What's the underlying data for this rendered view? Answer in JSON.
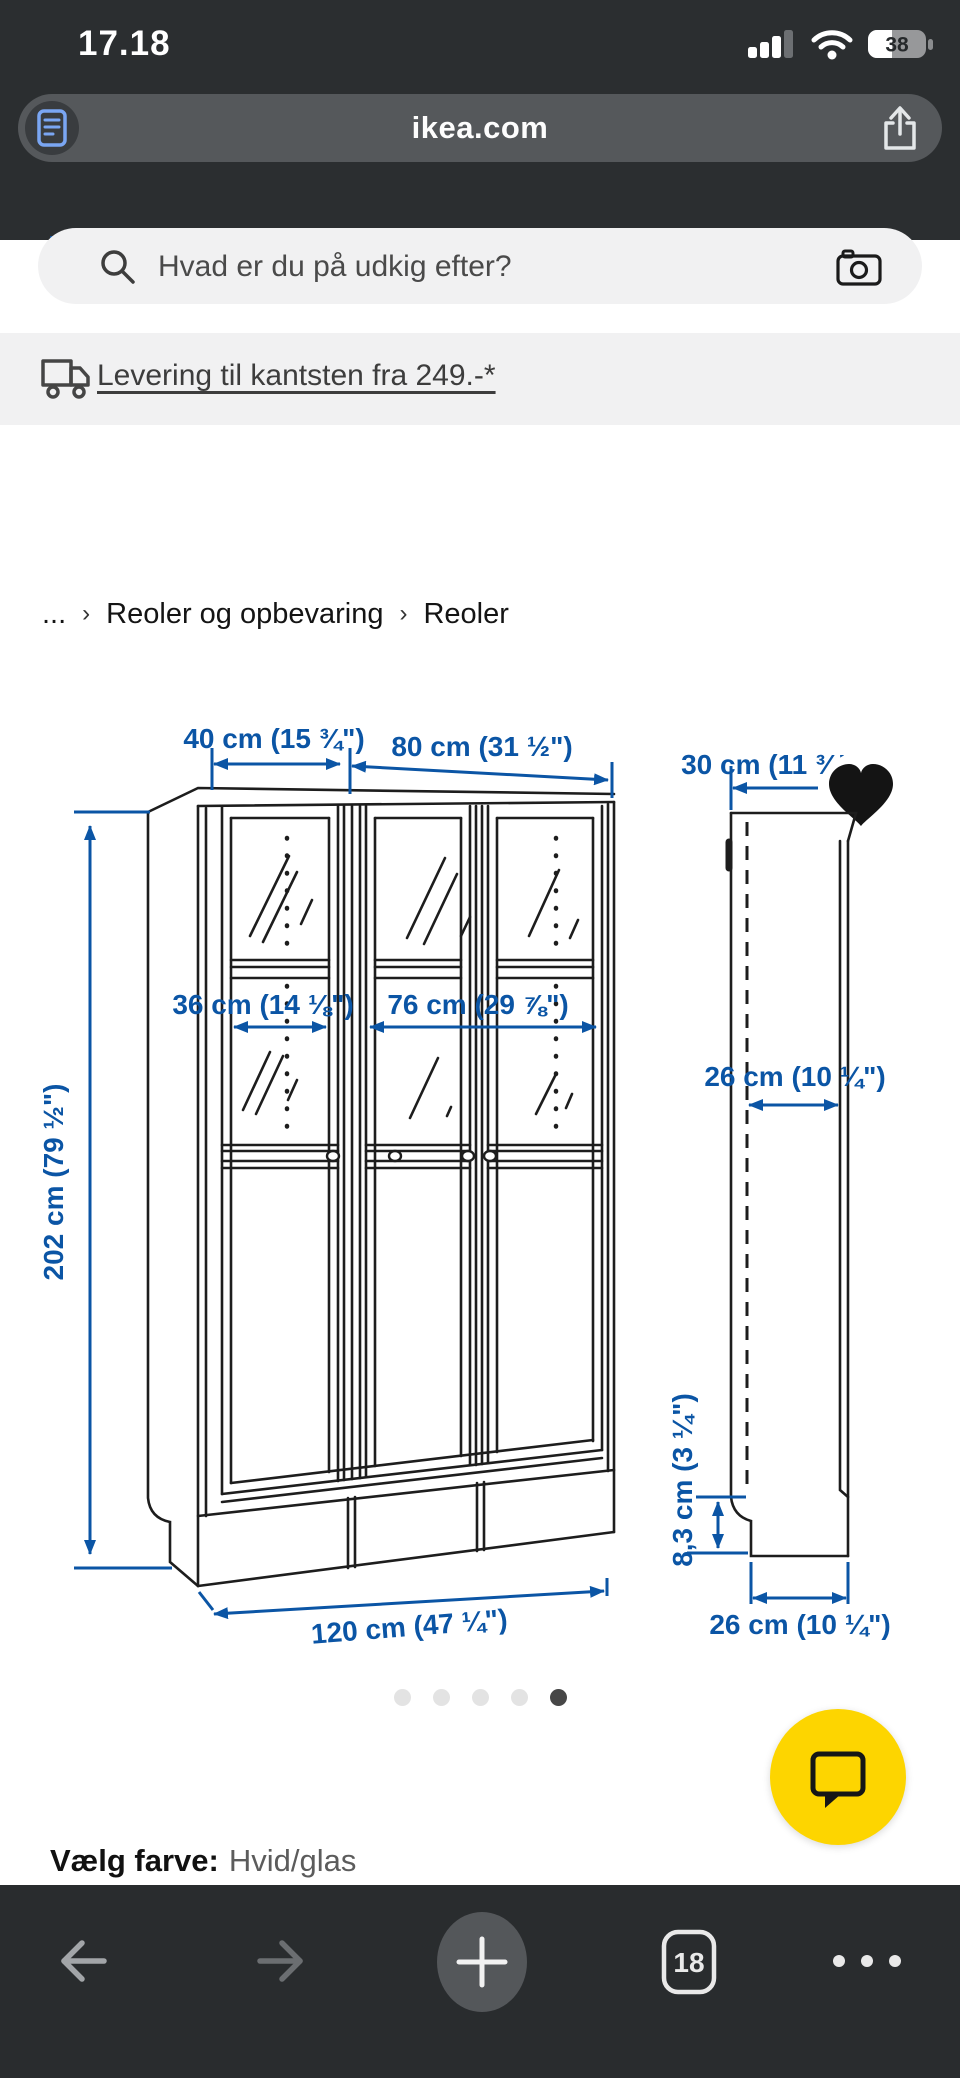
{
  "status_bar": {
    "time": "17.18",
    "battery_percent": "38"
  },
  "browser": {
    "url": "ikea.com"
  },
  "search": {
    "placeholder": "Hvad er du på udkig efter?"
  },
  "delivery": {
    "link_text": "Levering til kantsten fra 249.-*"
  },
  "breadcrumb": {
    "collapsed": "...",
    "separator": "›",
    "items": [
      "Reoler og opbevaring",
      "Reoler"
    ]
  },
  "product_image": {
    "dimensions": {
      "width_unit_small": "40 cm (15 ¾\")",
      "width_unit_large": "80 cm (31 ½\")",
      "depth_top": "30 cm (11 ¾\")",
      "inner_width_small": "36 cm (14 ⅛\")",
      "inner_width_large": "76 cm (29 ⅞\")",
      "inner_depth": "26 cm (10 ¼\")",
      "height": "202 cm (79 ½\")",
      "plinth_height": "8,3 cm (3 ¼\")",
      "total_width": "120 cm (47 ¼\")",
      "depth_bottom": "26 cm (10 ¼\")"
    }
  },
  "carousel": {
    "dot_count": 5,
    "active_index": 4
  },
  "color_option": {
    "label": "Vælg farve:",
    "value": "Hvid/glas"
  },
  "toolbar": {
    "tab_count": "18"
  },
  "colors": {
    "dimension_blue": "#0b55a5",
    "ikea_logo_blue": "#0d4e96",
    "ikea_yellow": "#fdd500",
    "chrome_dark": "#2b2e30"
  }
}
